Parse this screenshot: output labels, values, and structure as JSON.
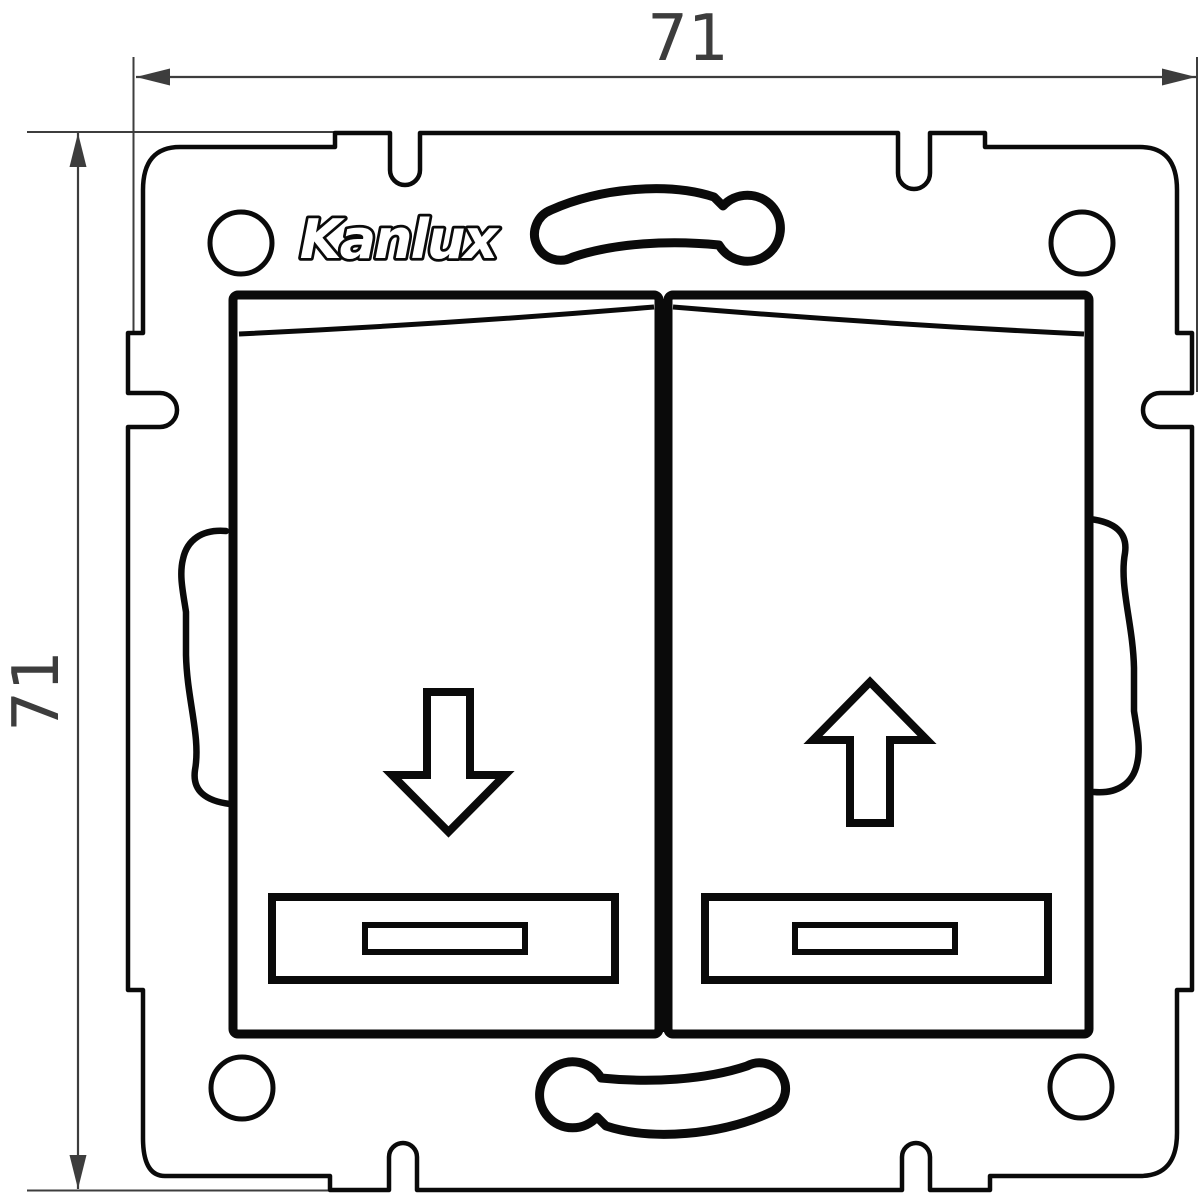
{
  "drawing": {
    "brand_logo": "Kanlux",
    "dimension_width_label": "71",
    "dimension_height_label": "71",
    "colors": {
      "ink": "#0a0a0a",
      "dimension_ink": "#3d3d3d",
      "background": "#ffffff"
    },
    "icons": {
      "left_button": "down-arrow",
      "right_button": "up-arrow"
    }
  }
}
